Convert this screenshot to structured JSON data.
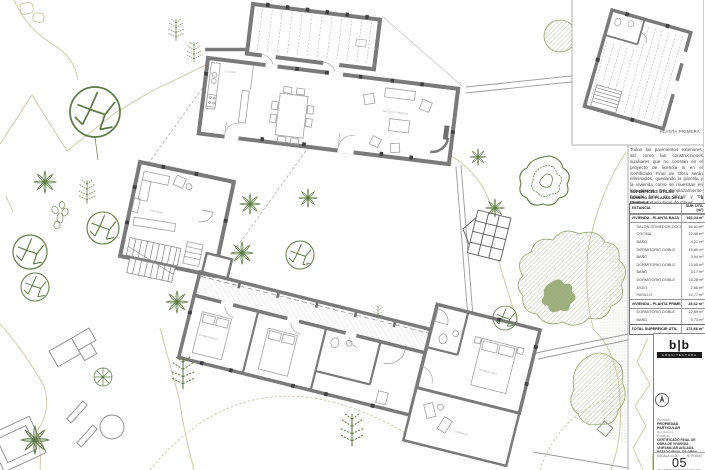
{
  "sheet": {
    "inset_label": "PLANTA PRIMERA",
    "note": "Todos los pavimentos exteriores, así como las construcciones auxiliares que no constan en el proyecto de licencia ni en el Certificado Final de Obra serán eliminados, quedando la parcela y la vivienda como se muestran en los planos '03 Emplazamiento-Estado Final de Obras' y '05 Plantas-Estado Final de Obras'.",
    "areas": {
      "title": "SUPERFICIES ÚTILES",
      "subtitle": "NÚMERO DE PLAZAS DE LA VIVIENDA",
      "subtitle_value": "8",
      "col_room": "ESTANCIA",
      "col_area": "SUP. ÚTIL (m²)",
      "rows": [
        {
          "label": "VIVIENDA - PLANTA BAJA",
          "value": "145,04 m²",
          "type": "group"
        },
        {
          "label": "SALÓN-COMEDOR-COCINA",
          "value": "56,81 m²",
          "type": "item"
        },
        {
          "label": "COCINA",
          "value": "12,46 m²",
          "type": "item"
        },
        {
          "label": "BAÑO",
          "value": "4,21 m²",
          "type": "item"
        },
        {
          "label": "DORMITORIO DOBLE",
          "value": "15,89 m²",
          "type": "item"
        },
        {
          "label": "BAÑO",
          "value": "3,94 m²",
          "type": "item"
        },
        {
          "label": "DORMITORIO DOBLE",
          "value": "13,65 m²",
          "type": "item"
        },
        {
          "label": "BAÑO",
          "value": "4,17 m²",
          "type": "item"
        },
        {
          "label": "DORMITORIO DOBLE",
          "value": "16,28 m²",
          "type": "item"
        },
        {
          "label": "ASEO",
          "value": "2,86 m²",
          "type": "item"
        },
        {
          "label": "PASILLO",
          "value": "14,77 m²",
          "type": "item"
        },
        {
          "label": "VIVIENDA - PLANTA PRIMERA",
          "value": "28,62 m²",
          "type": "group"
        },
        {
          "label": "DORMITORIO DOBLE",
          "value": "22,89 m²",
          "type": "item"
        },
        {
          "label": "BAÑO",
          "value": "5,73 m²",
          "type": "item"
        },
        {
          "label": "TOTAL SUPERFICIE ÚTIL",
          "value": "173,66 m²",
          "type": "total"
        }
      ]
    },
    "titleblock": {
      "logo_text": "b|b",
      "logo_caption": "ARQUITECTURA",
      "client_label": "Promotor:",
      "client_name": "PROPIEDAD PARTICULAR",
      "client_contact": "Illes Balears",
      "project_label": "Proyecto:",
      "project_lines": [
        "CERTIFICADO FINAL DE",
        "OBRA DE VIVIENDA",
        "UNIFAMILIAR AISLADA",
        "ESTADO FINAL DE OBRA"
      ],
      "scale_label": "ESCALA 1/100",
      "number_label": "Nº PLANO",
      "sheet_number": "05",
      "sheet_title": "PLANTAS-ESTADO FINAL DE OBRA"
    },
    "plan": {
      "room_labels": [
        "SALÓN-COMEDOR",
        "COCINA",
        "ESTUDIO",
        "DORMITORIO",
        "DORMITORIO",
        "TERRAZA"
      ]
    },
    "colors": {
      "wall": "#7a7a7a",
      "vegetation": "#5d7a44",
      "contour": "#cfc3a2"
    }
  }
}
